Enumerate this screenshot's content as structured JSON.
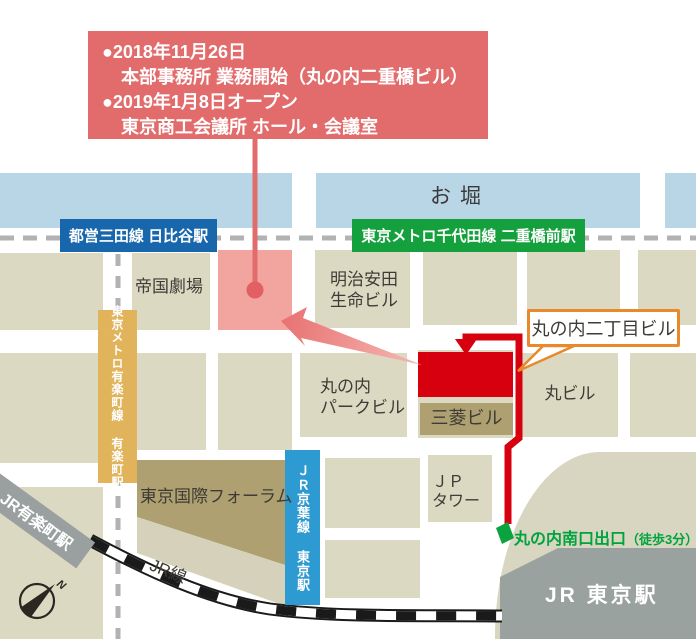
{
  "info_box": {
    "lines": [
      "●2018年11月26日",
      "本部事務所 業務開始（丸の内二重橋ビル）",
      "●2019年1月8日オープン",
      "東京商工会議所 ホール・会議室"
    ]
  },
  "stations": {
    "hibiya": "都営三田線 日比谷駅",
    "nijubashimae": "東京メトロ千代田線 二重橋前駅",
    "yurakucho_line": "東京メトロ有楽町線 有楽町駅",
    "keiyo_line": "ＪＲ京葉線 東京駅",
    "jr_yurakucho": "JR有楽町駅",
    "jr_tokyo": "JR 東京駅",
    "jr_line": "JR線"
  },
  "places": {
    "moat": "お堀",
    "teikoku_theater": "帝国劇場",
    "meiji_yasuda": "明治安田\n生命ビル",
    "marunouchi_park": "丸の内\nパークビル",
    "mitsubishi": "三菱ビル",
    "maru_building": "丸ビル",
    "intl_forum": "東京国際フォーラム",
    "jp_tower": "ＪＰ\nタワー"
  },
  "target": {
    "callout": "丸の内二丁目ビル"
  },
  "exit": {
    "main": "丸の内南口出口",
    "sub": "（徒歩3分）"
  },
  "compass": {
    "north": "N"
  },
  "colors": {
    "info_box_red": "#e26c6c",
    "highlight_pink": "#f2a49e",
    "target_red": "#d7000f",
    "route_red": "#d7000f",
    "arrow_salmon": "#e87a7a",
    "mita_line_blue": "#1866ab",
    "chiyoda_line_green": "#14a03c",
    "yurakucho_line_gold": "#e1b45c",
    "keiyo_line_blue": "#2e9ad2",
    "exit_green": "#00a33e",
    "callout_border_orange": "#e8892b",
    "water_blue": "#b9d6e7",
    "block_beige": "#dcd9c3",
    "block_khaki": "#aea070",
    "station_gray": "#9aa2a0"
  }
}
